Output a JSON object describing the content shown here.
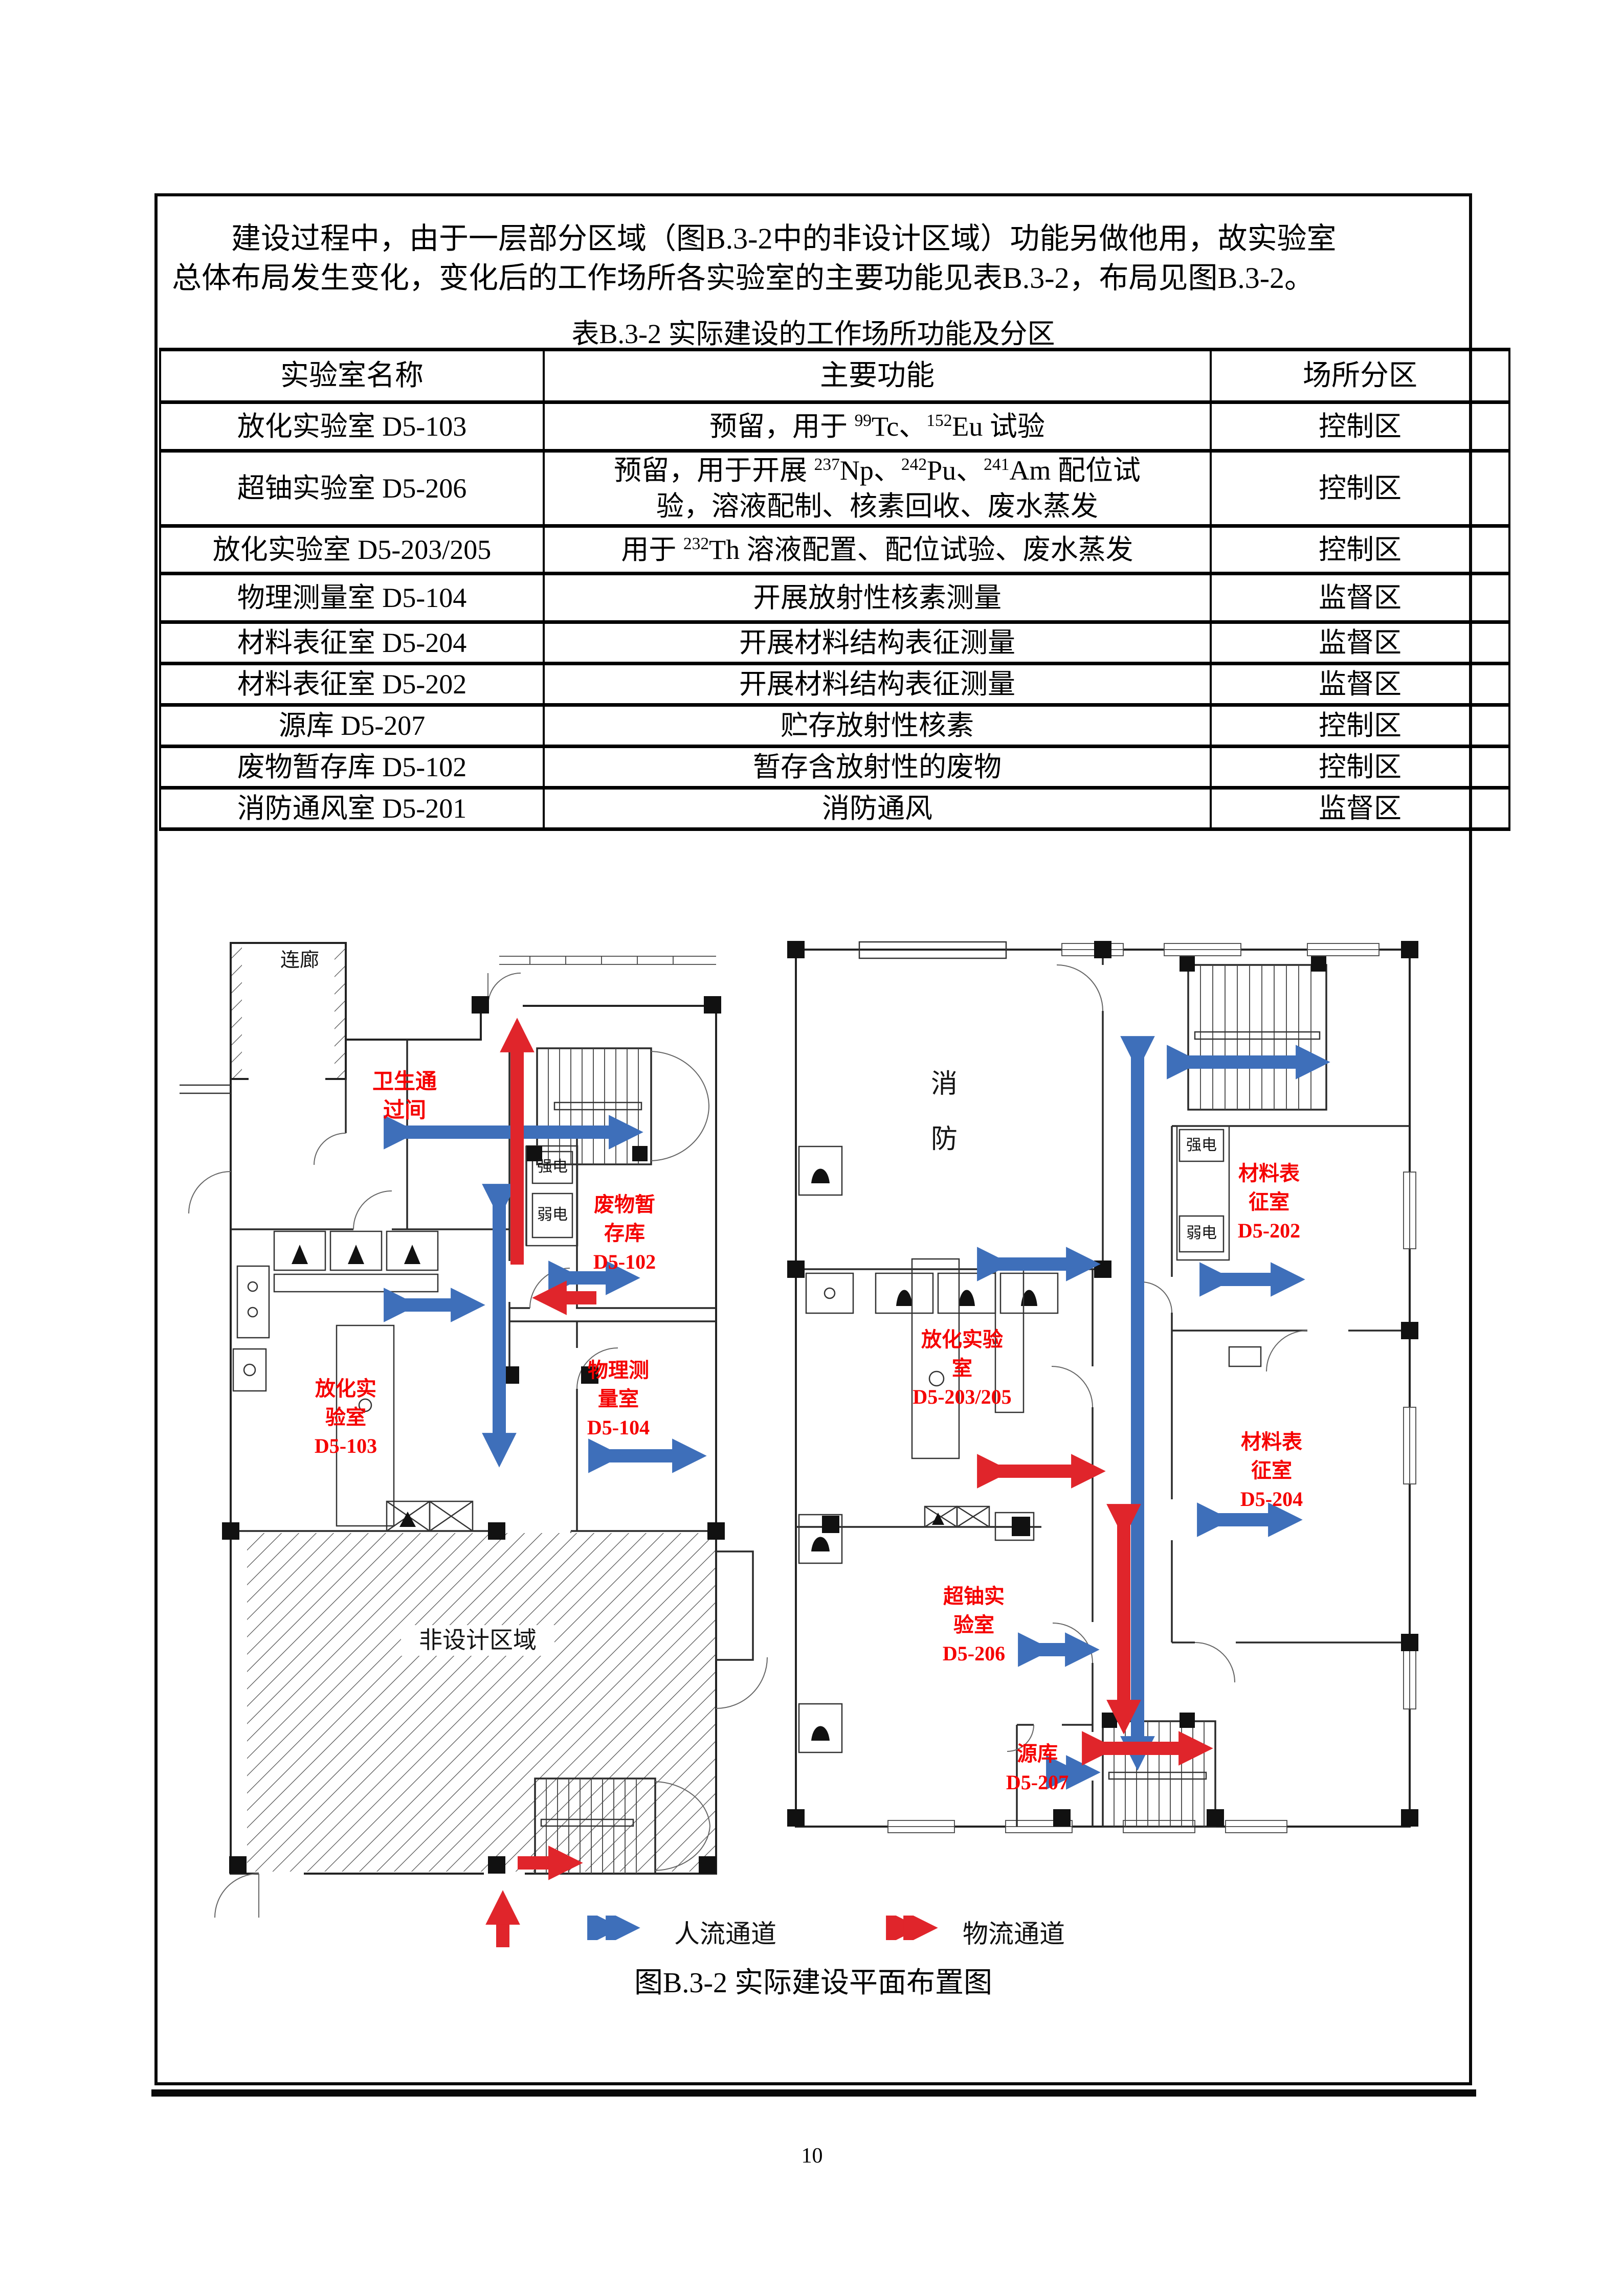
{
  "page": {
    "number": "10"
  },
  "intro_paragraph": "　　建设过程中，由于一层部分区域（图B.3-2中的非设计区域）功能另做他用，故实验室\n总体布局发生变化，变化后的工作场所各实验室的主要功能见表B.3-2，布局见图B.3-2。",
  "table": {
    "title": "表B.3-2 实际建设的工作场所功能及分区",
    "headers": [
      "实验室名称",
      "主要功能",
      "场所分区"
    ],
    "rows": [
      {
        "name": "放化实验室 D5-103",
        "func": [
          {
            "t": "预留，用于 "
          },
          {
            "s": "99"
          },
          {
            "t": "Tc、"
          },
          {
            "s": "152"
          },
          {
            "t": "Eu 试验"
          }
        ],
        "zone": "控制区",
        "cls": "r0"
      },
      {
        "name": "超铀实验室 D5-206",
        "func": [
          {
            "t": "预留，用于开展 "
          },
          {
            "s": "237"
          },
          {
            "t": "Np、"
          },
          {
            "s": "242"
          },
          {
            "t": "Pu、"
          },
          {
            "s": "241"
          },
          {
            "t": "Am 配位试\n验，溶液配制、核素回收、废水蒸发"
          }
        ],
        "zone": "控制区",
        "cls": "r1"
      },
      {
        "name": "放化实验室 D5-203/205",
        "func": [
          {
            "t": "用于 "
          },
          {
            "s": "232"
          },
          {
            "t": "Th 溶液配置、配位试验、废水蒸发"
          }
        ],
        "zone": "控制区",
        "cls": "r2"
      },
      {
        "name": "物理测量室 D5-104",
        "func": [
          {
            "t": "开展放射性核素测量"
          }
        ],
        "zone": "监督区",
        "cls": "r3"
      },
      {
        "name": "材料表征室 D5-204",
        "func": [
          {
            "t": "开展材料结构表征测量"
          }
        ],
        "zone": "监督区",
        "cls": "rs"
      },
      {
        "name": "材料表征室 D5-202",
        "func": [
          {
            "t": "开展材料结构表征测量"
          }
        ],
        "zone": "监督区",
        "cls": "rs"
      },
      {
        "name": "源库 D5-207",
        "func": [
          {
            "t": "贮存放射性核素"
          }
        ],
        "zone": "控制区",
        "cls": "rs"
      },
      {
        "name": "废物暂存库 D5-102",
        "func": [
          {
            "t": "暂存含放射性的废物"
          }
        ],
        "zone": "控制区",
        "cls": "rs"
      },
      {
        "name": "消防通风室 D5-201",
        "func": [
          {
            "t": "消防通风"
          }
        ],
        "zone": "监督区",
        "cls": "rs"
      }
    ]
  },
  "figure": {
    "caption": "图B.3-2 实际建设平面布置图",
    "legend": [
      {
        "label": "人流通道"
      },
      {
        "label": "物流通道"
      }
    ],
    "plan_left": {
      "corridor": "连廊",
      "sanitary_pass": "卫生通\n过间",
      "power_strong": "强电",
      "power_weak": "弱电",
      "waste_store": "废物暂\n存库\nD5-102",
      "rad_lab_103": "放化实\n验室\nD5-103",
      "phys_room_104": "物理测\n量室\nD5-104",
      "non_design": "非设计区域"
    },
    "plan_right": {
      "fire": "消\n防",
      "power_strong": "强电",
      "power_weak": "弱电",
      "mat_room_202": "材料表\n征室\nD5-202",
      "rad_lab_203_205": "放化实验\n室\nD5-203/205",
      "mat_room_204": "材料表\n征室\nD5-204",
      "trans_lab_206": "超铀实\n验室\nD5-206",
      "source_store_207": "源库\nD5-207"
    }
  },
  "colors": {
    "people_flow_blue": "#3e6fba",
    "material_flow_red": "#e0252b",
    "label_red": "#f50000"
  }
}
